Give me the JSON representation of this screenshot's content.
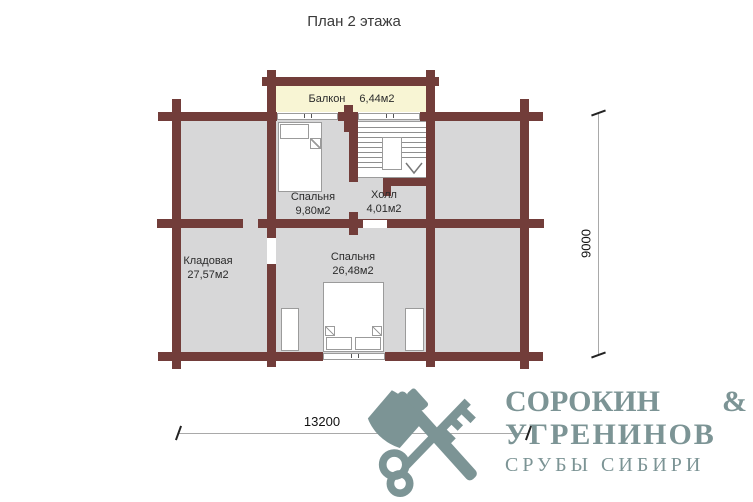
{
  "title": "План 2 этажа",
  "colors": {
    "wall": "#723d3a",
    "room": "#d7d7d8",
    "balcony": "#f8f5d4",
    "logo": "#7c9495"
  },
  "rooms": {
    "balcony": {
      "name": "Балкон",
      "area": "6,44м2"
    },
    "bedroom_small": {
      "name": "Спальня",
      "area": "9,80м2"
    },
    "hall": {
      "name": "Холл",
      "area": "4,01м2"
    },
    "storage": {
      "name": "Кладовая",
      "area": "27,57м2"
    },
    "bedroom_large": {
      "name": "Спальня",
      "area": "26,48м2"
    }
  },
  "dimensions": {
    "width_mm": "13200",
    "height_mm": "9000"
  },
  "logo": {
    "name1": "СОРОКИН",
    "amp": "&",
    "name2": "УГРЕНИНОВ",
    "tagline": "СРУБЫ СИБИРИ",
    "icon": "axe-key-icon"
  }
}
